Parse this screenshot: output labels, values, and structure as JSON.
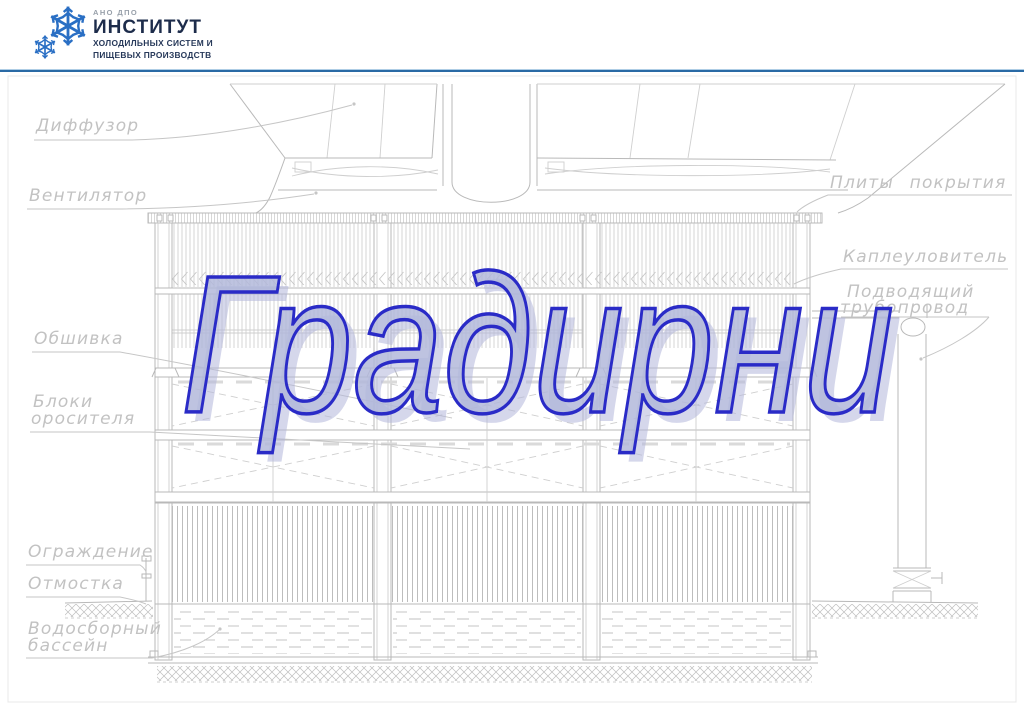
{
  "logo": {
    "org_type": "АНО ДПО",
    "name": "ИНСТИТУТ",
    "sub_line1": "ХОЛОДИЛЬНЫХ СИСТЕМ И",
    "sub_line2": "ПИЩЕВЫХ ПРОИЗВОДСТВ",
    "snowflake_color": "#2a6fc4",
    "name_color": "#1d2c4b"
  },
  "divider_color": "#2a6aa5",
  "title": {
    "text": "Градирни",
    "fill_color": "#b2b7da",
    "outline_color": "#2a2bc7"
  },
  "diagram": {
    "line_color": "#b9b9b9",
    "label_color": "#c2c2c2",
    "labels": {
      "diffuser": "Диффузор",
      "fan": "Вентилятор",
      "cladding": "Обшивка",
      "sprinkler_line1": "Блоки",
      "sprinkler_line2": "оросителя",
      "fence": "Ограждение",
      "blind_area": "Отмостка",
      "basin_line1": "Водосборный",
      "basin_line2": "бассейн",
      "cover_plates": "Плиты покрытия",
      "drift_eliminator": "Каплеуловитель",
      "supply_line1": "Подводящий",
      "supply_line2": "трубопровод"
    }
  }
}
